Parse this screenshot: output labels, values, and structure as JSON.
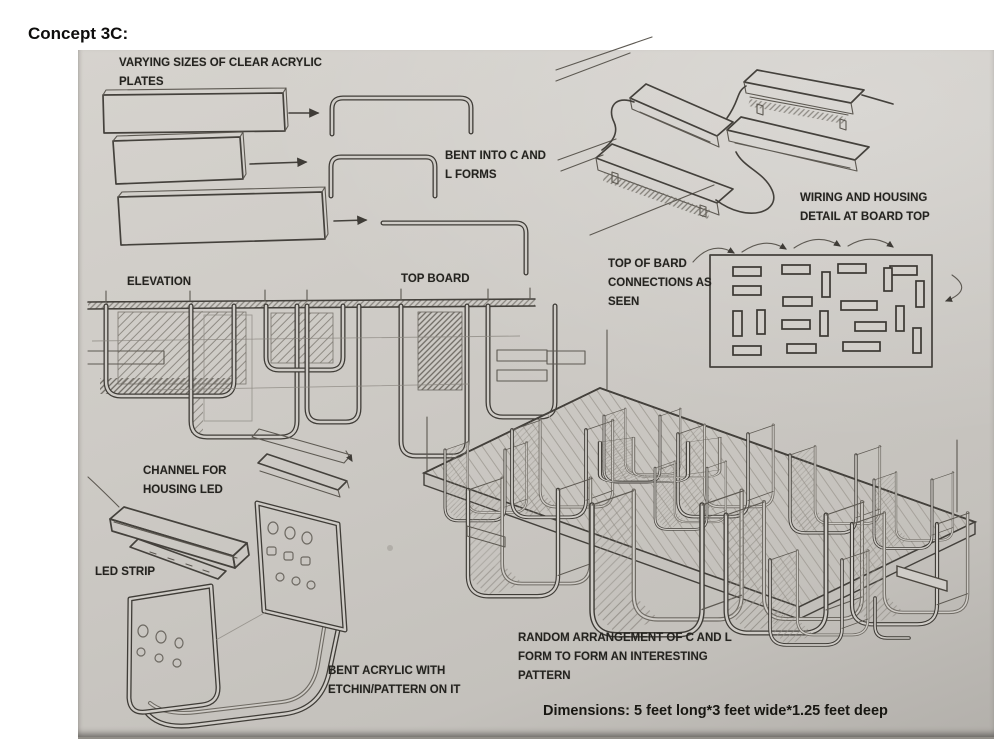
{
  "page": {
    "title": "Concept 3C:"
  },
  "annotations": {
    "plates": "VARYING SIZES OF CLEAR ACRYLIC PLATES",
    "bent_forms": "BENT INTO C AND L FORMS",
    "wiring": "WIRING AND HOUSING DETAIL AT BOARD TOP",
    "board_connections": "TOP OF BARD CONNECTIONS AS SEEN",
    "elevation": "ELEVATION",
    "top_board": "TOP BOARD",
    "channel": "CHANNEL FOR HOUSING LED",
    "led_strip": "LED STRIP",
    "etched_acrylic": "BENT ACRYLIC WITH ETCHIN/PATTERN ON IT",
    "arrangement": "RANDOM ARRANGEMENT OF C AND L FORM TO FORM AN INTERESTING PATTERN",
    "dimensions": "Dimensions: 5 feet long*3 feet wide*1.25 feet deep"
  },
  "colors": {
    "paper": "#cdcac5",
    "pencil": "#44413c",
    "label_text": "#24231f"
  }
}
